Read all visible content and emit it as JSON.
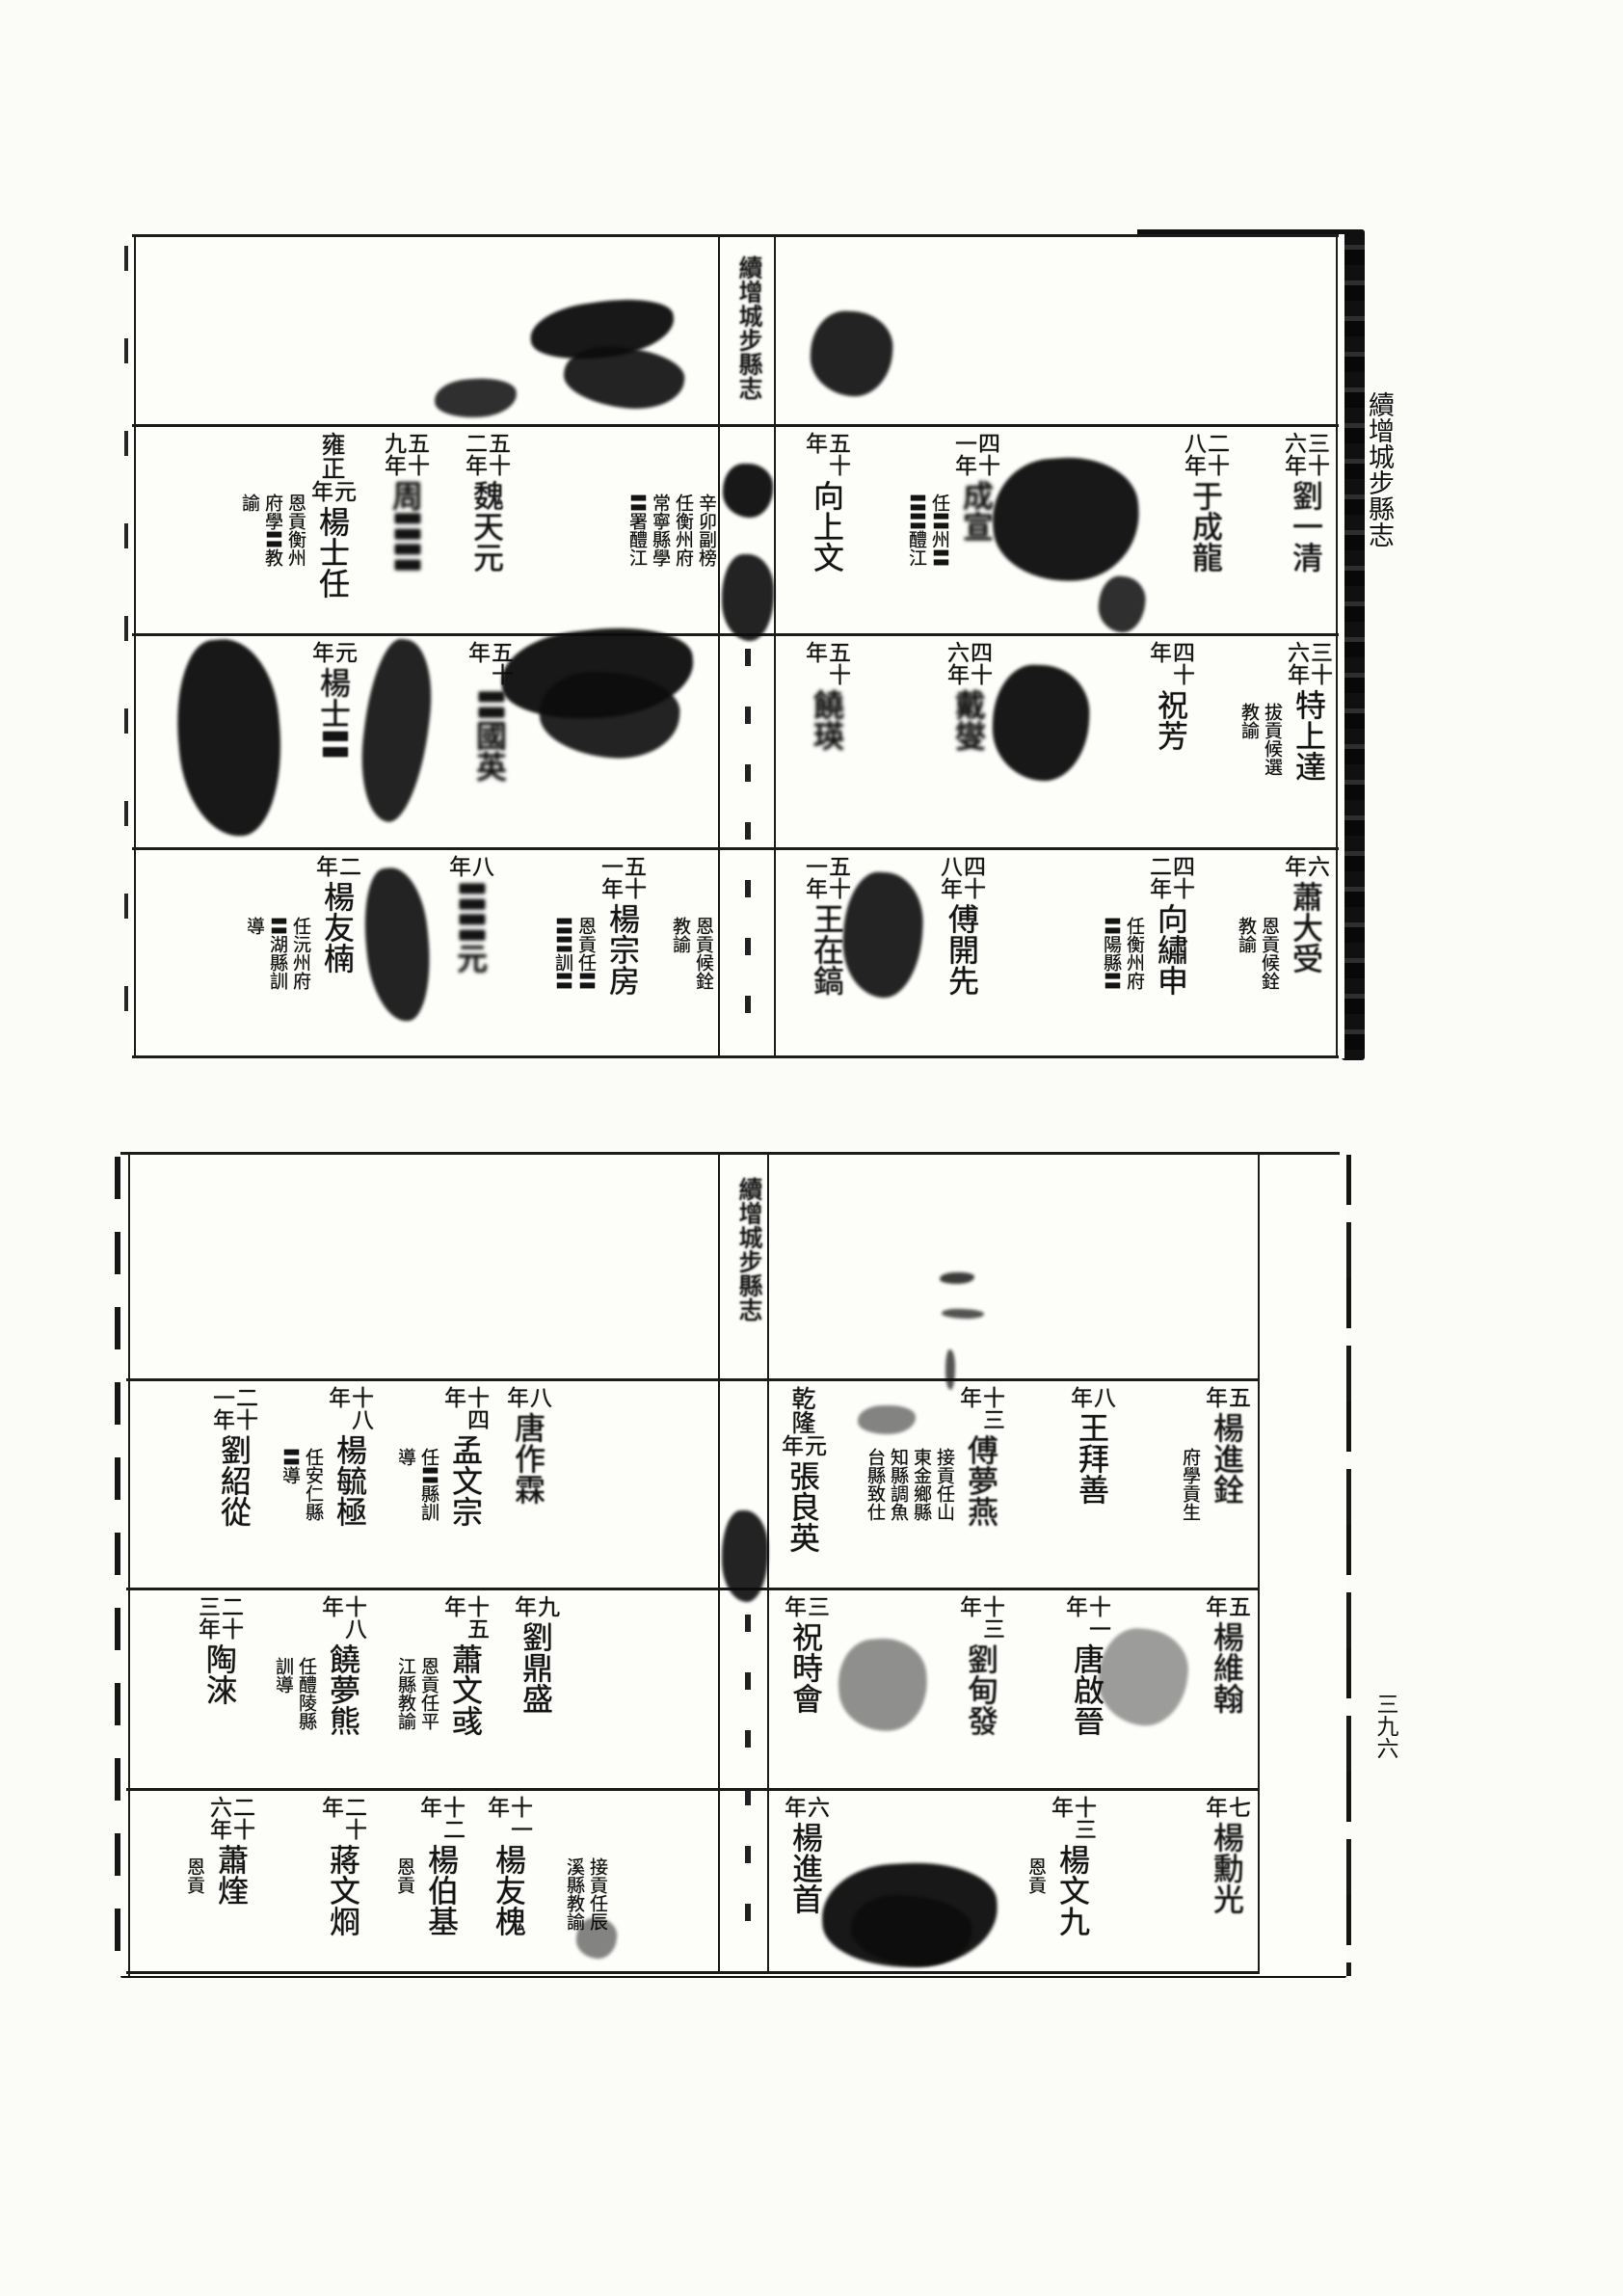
{
  "margin": {
    "title": "續增城步縣志",
    "page_number": "三九六"
  },
  "leaves": [
    {
      "name": "top-leaf",
      "fold_title": "續增城步縣志",
      "bands": [
        {
          "entries": [
            {
              "rx": 18,
              "year": [
                "三十",
                "六年"
              ],
              "name": "劉一清",
              "smudge": "light"
            },
            {
              "rx": 122,
              "year": [
                "二十",
                "八年"
              ],
              "name": "于成龍",
              "smudge": "light"
            },
            {
              "rx": 360,
              "year": [
                "四十",
                "一年"
              ],
              "name": "成宣",
              "smudge": "heavy",
              "annotations": [
                "任〓州〓",
                "〓〓醴江"
              ]
            },
            {
              "rx": 515,
              "year": [
                "五十",
                "年"
              ],
              "name": "向上文"
            },
            {
              "rx": 652,
              "annotations": [
                "辛卯副榜",
                "任衡州府",
                "常寧縣學",
                "〓署醴江"
              ]
            },
            {
              "rx": 868,
              "year": [
                "五十",
                "二年"
              ],
              "name": "魏天元",
              "smudge": "light"
            },
            {
              "rx": 952,
              "year": [
                "五十",
                "九年"
              ],
              "name": "周〓〓",
              "smudge": "heavy"
            },
            {
              "rx": 1028,
              "era": "雍正",
              "year": [
                "元",
                "年"
              ],
              "name": "楊士任",
              "annotations": [
                "恩貢衡州",
                "府學〓教",
                "諭"
              ]
            }
          ]
        },
        {
          "entries": [
            {
              "rx": 15,
              "year": [
                "三十",
                "六年"
              ],
              "name": "特上達",
              "annotations": [
                "拔貢候選",
                "教諭"
              ]
            },
            {
              "rx": 158,
              "year": [
                "四十",
                "年"
              ],
              "name": "祝芳"
            },
            {
              "rx": 368,
              "year": [
                "四十",
                "六年"
              ],
              "name": "戴燮",
              "smudge": "heavy"
            },
            {
              "rx": 515,
              "year": [
                "五十",
                "年"
              ],
              "name": "饒瑛",
              "smudge": "heavy"
            },
            {
              "rx": 865,
              "year": [
                "五十",
                "年"
              ],
              "name": "〓國英",
              "smudge": "heavy"
            },
            {
              "rx": 1027,
              "year": [
                "元",
                "年"
              ],
              "name": "楊士〓",
              "smudge": "light"
            }
          ]
        },
        {
          "entries": [
            {
              "rx": 18,
              "year": [
                "六",
                "年"
              ],
              "name": "蕭大受",
              "smudge": "light",
              "annotations": [
                "恩貢候銓",
                "教諭"
              ]
            },
            {
              "rx": 158,
              "year": [
                "四十",
                "二年"
              ],
              "name": "向繡申",
              "annotations": [
                "任衡州府",
                "〓陽縣〓"
              ]
            },
            {
              "rx": 375,
              "year": [
                "四十",
                "八年"
              ],
              "name": "傅開先"
            },
            {
              "rx": 515,
              "year": [
                "五十",
                "一年"
              ],
              "name": "王在鎬",
              "smudge": "light"
            },
            {
              "rx": 655,
              "annotations": [
                "恩貢候銓",
                "教諭"
              ]
            },
            {
              "rx": 727,
              "year": [
                "五十",
                "一年"
              ],
              "name": "楊宗房",
              "annotations": [
                "恩貢任〓",
                "〓〓訓〓"
              ]
            },
            {
              "rx": 885,
              "year": [
                "八",
                "年"
              ],
              "name": "〓〓元",
              "smudge": "heavy"
            },
            {
              "rx": 1023,
              "year": [
                "二",
                "年"
              ],
              "name": "楊友楠",
              "annotations": [
                "任沅州府",
                "〓湖縣訓",
                "導"
              ]
            }
          ]
        }
      ]
    },
    {
      "name": "bottom-leaf",
      "fold_title": "續增城步縣志",
      "bands": [
        {
          "entries": [
            {
              "rx": 102,
              "year": [
                "五",
                "年"
              ],
              "name": "楊進銓",
              "smudge": "light",
              "annotations": [
                "府學貢生"
              ]
            },
            {
              "rx": 242,
              "year": [
                "八",
                "年"
              ],
              "name": "王拜善"
            },
            {
              "rx": 357,
              "year": [
                "十三",
                "年"
              ],
              "name": "傅夢燕",
              "smudge": "light",
              "annotations": [
                "接貢任山",
                "東金鄉縣",
                "知縣調魚",
                "台縣致仕"
              ]
            },
            {
              "rx": 542,
              "era": "乾隆",
              "year": [
                "元",
                "年"
              ],
              "name": "張良英"
            },
            {
              "rx": 827,
              "year": [
                "八",
                "年"
              ],
              "name": "唐作霖",
              "smudge": "light"
            },
            {
              "rx": 892,
              "year": [
                "十四",
                "年"
              ],
              "name": "孟文宗",
              "annotations": [
                "任〓縣訓",
                "導"
              ]
            },
            {
              "rx": 1012,
              "year": [
                "十八",
                "年"
              ],
              "name": "楊毓極",
              "annotations": [
                "任安仁縣",
                "〓導"
              ]
            },
            {
              "rx": 1132,
              "year": [
                "二十",
                "一年"
              ],
              "name": "劉紹從"
            }
          ]
        },
        {
          "entries": [
            {
              "rx": 102,
              "year": [
                "五",
                "年"
              ],
              "name": "楊維翰",
              "smudge": "light"
            },
            {
              "rx": 247,
              "year": [
                "十一",
                "年"
              ],
              "name": "唐啟晉"
            },
            {
              "rx": 357,
              "year": [
                "十三",
                "年"
              ],
              "name": "劉甸發",
              "smudge": "light"
            },
            {
              "rx": 539,
              "year": [
                "三",
                "年"
              ],
              "name": "祝時會"
            },
            {
              "rx": 819,
              "year": [
                "九",
                "年"
              ],
              "name": "劉鼎盛"
            },
            {
              "rx": 892,
              "year": [
                "十五",
                "年"
              ],
              "name": "蕭文彧",
              "annotations": [
                "恩貢任平",
                "江縣教諭"
              ]
            },
            {
              "rx": 1019,
              "year": [
                "十八",
                "年"
              ],
              "name": "饒夢熊",
              "annotations": [
                "任醴陵縣",
                "訓導"
              ]
            },
            {
              "rx": 1147,
              "year": [
                "二十",
                "三年"
              ],
              "name": "陶淶"
            }
          ]
        },
        {
          "entries": [
            {
              "rx": 102,
              "year": [
                "七",
                "年"
              ],
              "name": "楊勳光",
              "smudge": "light"
            },
            {
              "rx": 262,
              "year": [
                "十三",
                "年"
              ],
              "name": "楊文九",
              "annotations": [
                "恩貢"
              ]
            },
            {
              "rx": 539,
              "year": [
                "六",
                "年"
              ],
              "name": "楊進首"
            },
            {
              "rx": 767,
              "annotations": [
                "接貢任辰",
                "溪縣教諭"
              ]
            },
            {
              "rx": 847,
              "year": [
                "十一",
                "年"
              ],
              "name": "楊友槐"
            },
            {
              "rx": 917,
              "year": [
                "十二",
                "年"
              ],
              "name": "楊伯基",
              "annotations": [
                "恩貢"
              ]
            },
            {
              "rx": 1019,
              "year": [
                "二十",
                "年"
              ],
              "name": "蔣文烱"
            },
            {
              "rx": 1135,
              "year": [
                "二十",
                "六年"
              ],
              "name": "蕭煃",
              "annotations": [
                "恩貢"
              ]
            }
          ]
        }
      ]
    }
  ]
}
